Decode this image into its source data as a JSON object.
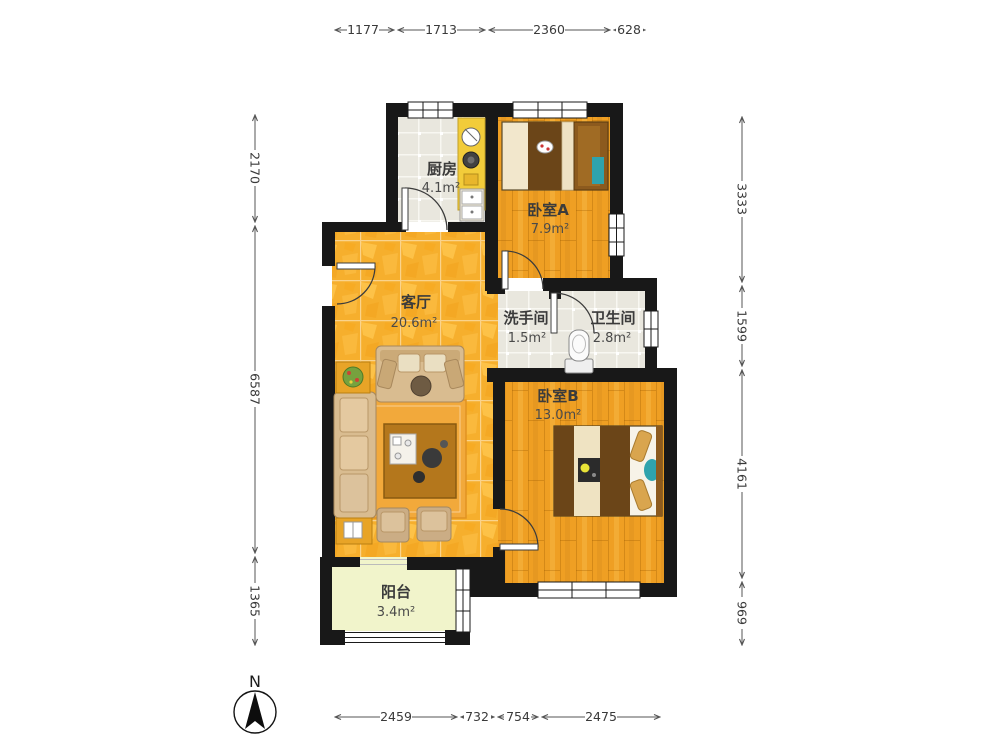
{
  "rooms": {
    "kitchen": {
      "name": "厨房",
      "area": "4.1m²"
    },
    "bedroomA": {
      "name": "卧室A",
      "area": "7.9m²"
    },
    "living": {
      "name": "客厅",
      "area": "20.6m²"
    },
    "washroom": {
      "name": "洗手间",
      "area": "1.5m²"
    },
    "bathroom": {
      "name": "卫生间",
      "area": "2.8m²"
    },
    "bedroomB": {
      "name": "卧室B",
      "area": "13.0m²"
    },
    "balcony": {
      "name": "阳台",
      "area": "3.4m²"
    }
  },
  "dims": {
    "top": [
      "1177",
      "1713",
      "2360",
      "628"
    ],
    "bottom": [
      "2459",
      "732",
      "754",
      "2475"
    ],
    "left": [
      "2170",
      "6587",
      "1365"
    ],
    "right": [
      "3333",
      "1599",
      "4161",
      "969"
    ]
  },
  "compass": {
    "north": "N"
  },
  "colors": {
    "wall": "#181818",
    "living_floor": "#F6AF2D",
    "bedroom_floor": "#EF9F23",
    "tile_floor": "#E9E7DE",
    "balcony_floor": "#F1F4CB",
    "accent_teal": "#2FA3AD",
    "duvet_brown": "#6B4518"
  }
}
